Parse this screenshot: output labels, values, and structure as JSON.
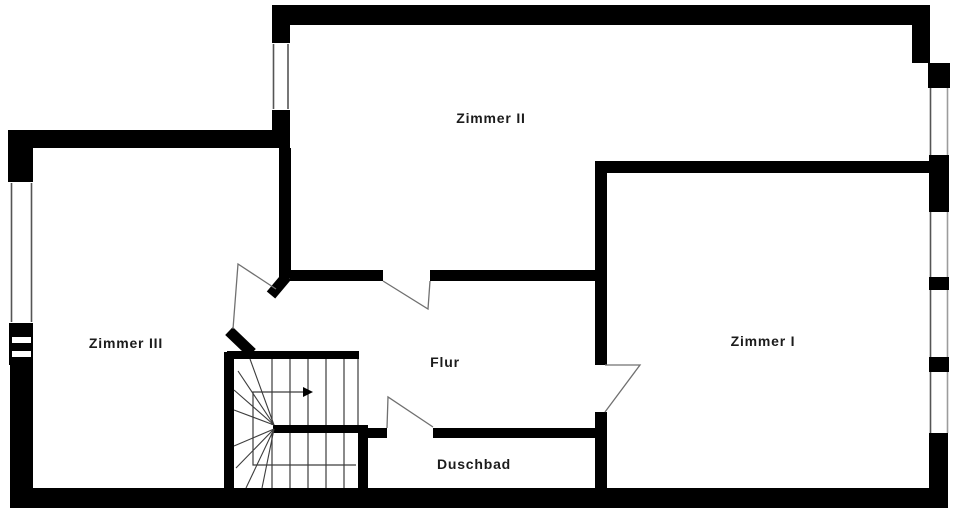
{
  "plan": {
    "width": 960,
    "height": 517,
    "colors": {
      "bg": "#ffffff",
      "wall": "#000000",
      "thin_line": "#3d3d3d",
      "door_line": "#707070",
      "window_inner_line": "#555555",
      "window_outer_line": "#9c9c9c",
      "glass": "#ffffff",
      "label": "#1c1c1c"
    },
    "rooms": [
      {
        "id": "zimmer-2",
        "label": "Zimmer II",
        "cx": 491,
        "cy": 118,
        "font_size": 14
      },
      {
        "id": "zimmer-1",
        "label": "Zimmer I",
        "cx": 763,
        "cy": 341,
        "font_size": 14
      },
      {
        "id": "zimmer-3",
        "label": "Zimmer III",
        "cx": 126,
        "cy": 343,
        "font_size": 14
      },
      {
        "id": "flur",
        "label": "Flur",
        "cx": 445,
        "cy": 362,
        "font_size": 14
      },
      {
        "id": "duschbad",
        "label": "Duschbad",
        "cx": 474,
        "cy": 464,
        "font_size": 14
      }
    ],
    "wall_rects": [
      {
        "name": "outer-wall-top",
        "x": 272,
        "y": 5,
        "w": 658,
        "h": 20
      },
      {
        "name": "zimmer2-west-wall-upper",
        "x": 272,
        "y": 5,
        "w": 18,
        "h": 38
      },
      {
        "name": "zimmer2-west-wall-lower",
        "x": 272,
        "y": 110,
        "w": 18,
        "h": 38
      },
      {
        "name": "zimmer3-north-wall",
        "x": 8,
        "y": 130,
        "w": 282,
        "h": 18
      },
      {
        "name": "west-wall-corner-block",
        "x": 8,
        "y": 130,
        "w": 25,
        "h": 52
      },
      {
        "name": "west-wall-mid-block",
        "x": 9,
        "y": 323,
        "w": 24,
        "h": 42
      },
      {
        "name": "west-wall-lower",
        "x": 10,
        "y": 360,
        "w": 23,
        "h": 148
      },
      {
        "name": "outer-wall-bottom",
        "x": 10,
        "y": 488,
        "w": 938,
        "h": 20
      },
      {
        "name": "east-wall-upper",
        "x": 912,
        "y": 5,
        "w": 18,
        "h": 58
      },
      {
        "name": "east-wall-bump",
        "x": 928,
        "y": 63,
        "w": 22,
        "h": 25
      },
      {
        "name": "east-wall-block-1",
        "x": 929,
        "y": 155,
        "w": 20,
        "h": 57
      },
      {
        "name": "east-wall-block-2",
        "x": 929,
        "y": 277,
        "w": 20,
        "h": 13
      },
      {
        "name": "east-wall-block-3",
        "x": 929,
        "y": 357,
        "w": 20,
        "h": 15
      },
      {
        "name": "east-wall-corner",
        "x": 929,
        "y": 433,
        "w": 19,
        "h": 75
      },
      {
        "name": "zimmer3-east-wall",
        "x": 279,
        "y": 148,
        "w": 12,
        "h": 130
      },
      {
        "name": "flur-north-wall-left",
        "x": 290,
        "y": 270,
        "w": 93,
        "h": 11
      },
      {
        "name": "flur-north-wall-right",
        "x": 430,
        "y": 270,
        "w": 177,
        "h": 11
      },
      {
        "name": "zimmer1-north-wall",
        "x": 595,
        "y": 161,
        "w": 335,
        "h": 12
      },
      {
        "name": "zimmer1-west-wall-upper",
        "x": 595,
        "y": 161,
        "w": 12,
        "h": 204
      },
      {
        "name": "zimmer1-west-wall-lower",
        "x": 595,
        "y": 412,
        "w": 12,
        "h": 80
      },
      {
        "name": "stair-west-wall",
        "x": 224,
        "y": 352,
        "w": 10,
        "h": 140
      },
      {
        "name": "stair-north-wall",
        "x": 227,
        "y": 351,
        "w": 132,
        "h": 8
      },
      {
        "name": "stair-mid-wall",
        "x": 273,
        "y": 425,
        "w": 95,
        "h": 8
      },
      {
        "name": "duschbad-west-wall",
        "x": 358,
        "y": 425,
        "w": 10,
        "h": 67
      },
      {
        "name": "duschbad-north-wall-left",
        "x": 358,
        "y": 428,
        "w": 29,
        "h": 10
      },
      {
        "name": "duschbad-north-wall-right",
        "x": 433,
        "y": 428,
        "w": 172,
        "h": 10
      }
    ],
    "wall_strokes": [
      {
        "name": "zimmer3-door-jamb-upper",
        "x1": 287,
        "y1": 276,
        "x2": 271,
        "y2": 295,
        "w": 11
      },
      {
        "name": "zimmer3-door-jamb-lower",
        "x1": 229,
        "y1": 331,
        "x2": 252,
        "y2": 353,
        "w": 11
      }
    ],
    "glass_rects": [
      {
        "name": "west-window-glass",
        "x": 10,
        "y": 182,
        "w": 23,
        "h": 141
      },
      {
        "name": "west-window-slit-1",
        "x": 12,
        "y": 337,
        "w": 19,
        "h": 6
      },
      {
        "name": "west-window-slit-2",
        "x": 12,
        "y": 351,
        "w": 19,
        "h": 6
      },
      {
        "name": "zimmer2-west-window-glass",
        "x": 272,
        "y": 43,
        "w": 18,
        "h": 67
      },
      {
        "name": "east-window-1-glass",
        "x": 929,
        "y": 88,
        "w": 20,
        "h": 67
      },
      {
        "name": "east-window-2-glass",
        "x": 929,
        "y": 212,
        "w": 20,
        "h": 65
      },
      {
        "name": "east-window-3-glass",
        "x": 929,
        "y": 290,
        "w": 20,
        "h": 67
      },
      {
        "name": "east-window-4-glass",
        "x": 929,
        "y": 372,
        "w": 20,
        "h": 61
      }
    ],
    "window_lines": [
      {
        "name": "west-window-line-outer",
        "x1": 11.5,
        "y1": 183,
        "x2": 11.5,
        "y2": 322,
        "color": "window_inner_line"
      },
      {
        "name": "west-window-line-inner",
        "x1": 31.5,
        "y1": 183,
        "x2": 31.5,
        "y2": 322,
        "color": "window_inner_line"
      },
      {
        "name": "zimmer2-window-line-outer",
        "x1": 273.5,
        "y1": 44,
        "x2": 273.5,
        "y2": 109,
        "color": "window_inner_line"
      },
      {
        "name": "zimmer2-window-line-inner",
        "x1": 288,
        "y1": 44,
        "x2": 288,
        "y2": 109,
        "color": "window_inner_line"
      },
      {
        "name": "east-window-1-line-inner",
        "x1": 930.5,
        "y1": 88,
        "x2": 930.5,
        "y2": 155,
        "color": "window_inner_line"
      },
      {
        "name": "east-window-1-line-outer",
        "x1": 947.5,
        "y1": 88,
        "x2": 947.5,
        "y2": 155,
        "color": "window_outer_line"
      },
      {
        "name": "east-window-2-line-inner",
        "x1": 930.5,
        "y1": 212,
        "x2": 930.5,
        "y2": 277,
        "color": "window_inner_line"
      },
      {
        "name": "east-window-2-line-outer",
        "x1": 947.5,
        "y1": 212,
        "x2": 947.5,
        "y2": 277,
        "color": "window_outer_line"
      },
      {
        "name": "east-window-3-line-inner",
        "x1": 930.5,
        "y1": 290,
        "x2": 930.5,
        "y2": 357,
        "color": "window_inner_line"
      },
      {
        "name": "east-window-3-line-outer",
        "x1": 947.5,
        "y1": 290,
        "x2": 947.5,
        "y2": 357,
        "color": "window_outer_line"
      },
      {
        "name": "east-window-4-line-inner",
        "x1": 930.5,
        "y1": 372,
        "x2": 930.5,
        "y2": 433,
        "color": "window_inner_line"
      },
      {
        "name": "east-window-4-line-outer",
        "x1": 947.5,
        "y1": 372,
        "x2": 947.5,
        "y2": 433,
        "color": "window_outer_line"
      }
    ],
    "door_polylines": [
      {
        "name": "zimmer2-door-swing",
        "points": "383,281 428,309 430,281"
      },
      {
        "name": "duschbad-door-swing",
        "points": "387,428 388,397 433,427"
      },
      {
        "name": "zimmer1-door-swing",
        "points": "605,365 640,365 605,412"
      },
      {
        "name": "zimmer3-door-swing",
        "points": "233,329 238,264 276,289"
      }
    ],
    "stairs": {
      "treads_upper": {
        "xs": [
          272,
          290,
          308,
          326,
          344,
          358
        ],
        "y1": 359,
        "y2": 425
      },
      "treads_lower": {
        "xs": [
          272,
          290,
          308,
          326,
          344
        ],
        "y1": 433,
        "y2": 488
      },
      "fan_upper": {
        "px": 274,
        "py": 425,
        "ends": [
          [
            250,
            359
          ],
          [
            238,
            371
          ],
          [
            234,
            390
          ],
          [
            234,
            410
          ]
        ]
      },
      "fan_lower": {
        "px": 274,
        "py": 429,
        "ends": [
          [
            234,
            446
          ],
          [
            236,
            468
          ],
          [
            246,
            488
          ],
          [
            262,
            488
          ]
        ]
      },
      "walk_line_points": "356,465 253,465 253,392 303,392",
      "arrow_head_points": "303,387 313,392 303,397"
    }
  }
}
